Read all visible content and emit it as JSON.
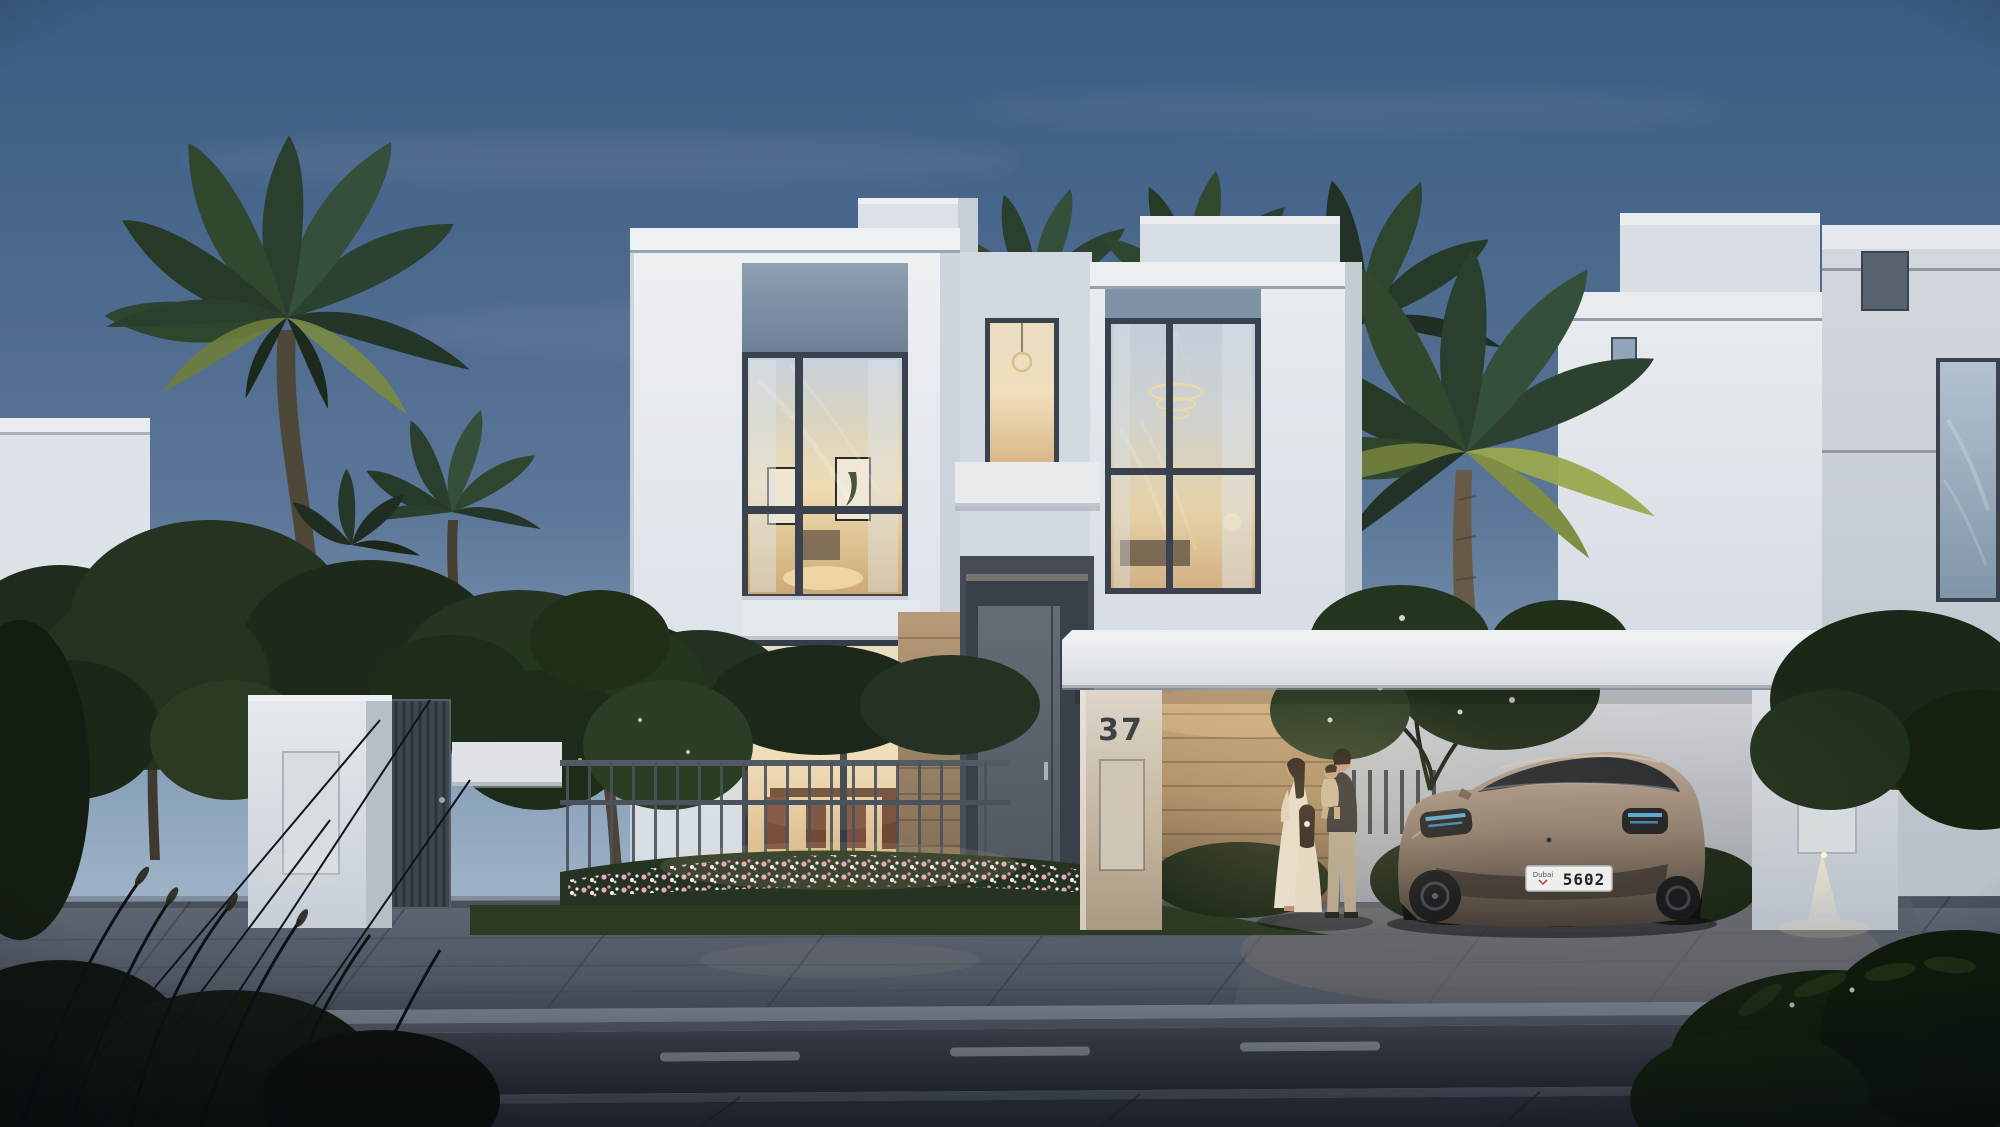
{
  "scene": {
    "house_number": "37",
    "car": {
      "license_plate_region": "Dubai",
      "license_plate_number": "5602",
      "body_color": "#9d8a7a"
    },
    "colors": {
      "sky_top": "#3a5b82",
      "sky_horizon": "#c9d5e0",
      "villa_wall": "#e6ebef",
      "spandrel_panel": "#7e91a4",
      "window_frame": "#39424e",
      "interior_glow": "#f0dcae",
      "wood_cladding": "#b4956f",
      "foliage_dark": "#22301f",
      "palm_lit": "#8d9a4a",
      "road_asphalt": "#383d46",
      "lane_marking": "#9aa3ad",
      "paver": "#59616e",
      "license_plate_bg": "#eef0f1"
    }
  }
}
